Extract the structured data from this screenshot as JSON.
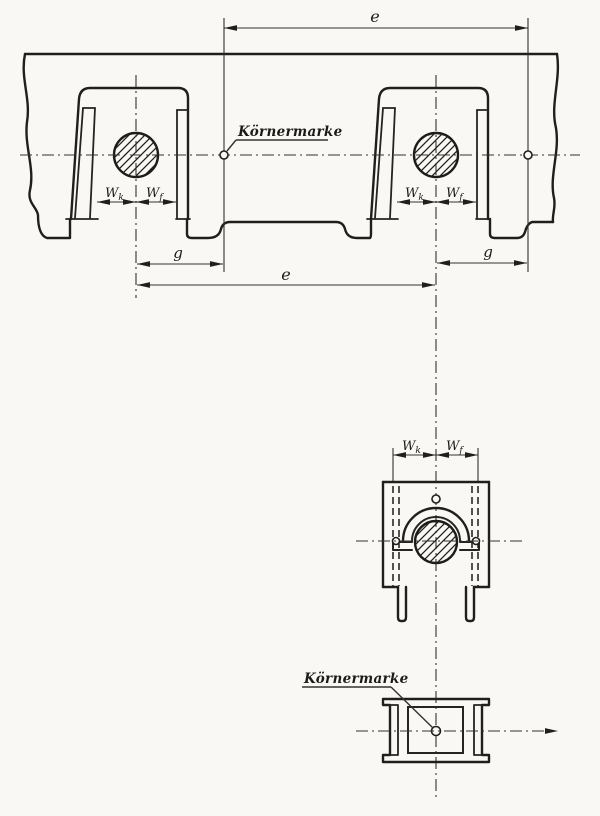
{
  "figure": {
    "labels": {
      "e": "e",
      "g": "g",
      "w": "W",
      "w_sub_k": "k",
      "w_sub_f": "f",
      "punch_mark": "Körnermarke"
    },
    "colors": {
      "ink": "#211f1c",
      "ink_thin": "#35322d",
      "paper": "#f9f8f4"
    }
  }
}
